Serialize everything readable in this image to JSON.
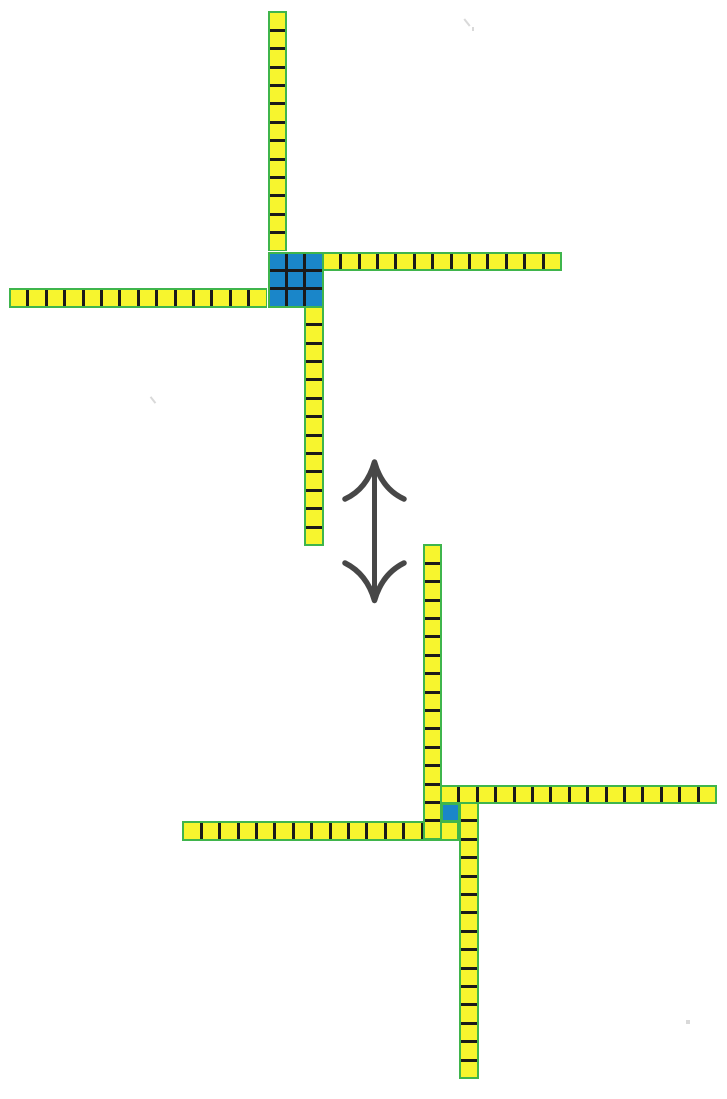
{
  "canvas": {
    "width": 727,
    "height": 1099,
    "background": "#ffffff"
  },
  "palette": {
    "cell_yellow": "#f7f52e",
    "outline_green": "#3fb54c",
    "overlap_blue": "#1a86c9",
    "divider_black": "#1a1a1a",
    "arrow_gray": "#474747",
    "artifact_gray": "#b9b9b9"
  },
  "grid": {
    "cell_px": 18.4,
    "divider_px": 3,
    "outline_px": 2
  },
  "assemblies": [
    {
      "id": "strong-state",
      "description": "upper assembly: four single-width slats meeting at a fully bound 3x3 blue overlap block",
      "junction": {
        "x": 268,
        "y": 252,
        "rows": 3,
        "cols": 3,
        "fill": "overlap_blue"
      },
      "strips": [
        {
          "name": "left-slat",
          "orientation": "h",
          "count": 14,
          "x": 10.4,
          "y": 288.8
        },
        {
          "name": "right-slat",
          "orientation": "h",
          "count": 13,
          "x": 323.2,
          "y": 252
        },
        {
          "name": "down-slat",
          "orientation": "v",
          "count": 13,
          "x": 304.8,
          "y": 307.2
        },
        {
          "name": "up-slat",
          "orientation": "v",
          "count": 13,
          "x": 268,
          "y": 12.8
        }
      ]
    },
    {
      "id": "weak-state",
      "description": "lower assembly: same four slats slipped apart so only one blue overlap cell remains at the center",
      "junction": null,
      "overlap_cell": {
        "x": 441.4,
        "y": 803.4
      },
      "strips": [
        {
          "name": "left-slat",
          "orientation": "h",
          "count": 15,
          "x": 183.8,
          "y": 821.8
        },
        {
          "name": "right-slat",
          "orientation": "h",
          "count": 15,
          "x": 441.4,
          "y": 785
        },
        {
          "name": "down-slat",
          "orientation": "v",
          "count": 15,
          "x": 459.8,
          "y": 803.4
        },
        {
          "name": "up-slat",
          "orientation": "v",
          "count": 16,
          "x": 423,
          "y": 545.8
        }
      ]
    }
  ],
  "arrow": {
    "meaning": "vertical double-headed equilibrium arrow between the two states",
    "left": 320,
    "top": 450,
    "width": 110,
    "height": 165,
    "viewbox": "320 450 110 165",
    "shaft_path": "M374.5 470 L374.5 592",
    "top_head_path": "M345 499 Q367 489 374.5 462 Q382 489 404 499",
    "bottom_head_path": "M345 563 Q367 574 374.5 600.5 Q382 574 404 563",
    "shaft_width": 5,
    "head_width": 5.5
  },
  "artifacts": [
    {
      "x": 466,
      "y": 18,
      "w": 2,
      "h": 9,
      "kind": "tick"
    },
    {
      "x": 472,
      "y": 27,
      "w": 2,
      "h": 4,
      "kind": "dot"
    },
    {
      "x": 152,
      "y": 396,
      "w": 2,
      "h": 8,
      "kind": "tick"
    },
    {
      "x": 686,
      "y": 1020,
      "w": 4,
      "h": 4,
      "kind": "dot"
    }
  ]
}
